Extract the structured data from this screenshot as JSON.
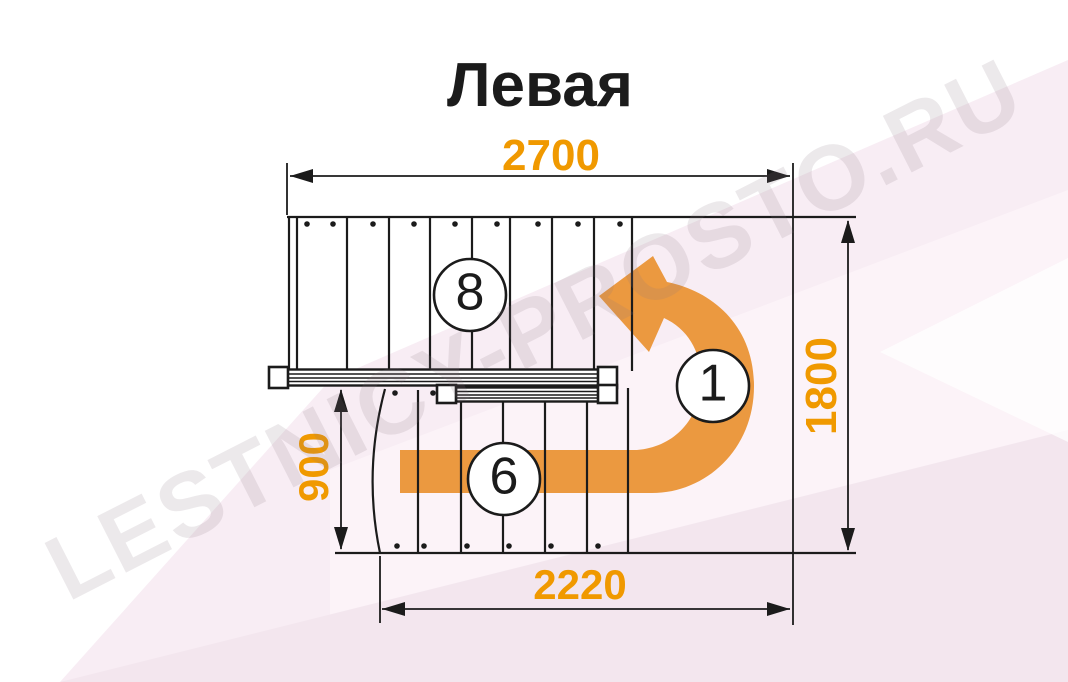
{
  "title": "Левая",
  "watermark": "LESTNICY-PROSTO.RU",
  "dimensions": {
    "top": "2700",
    "right": "1800",
    "left": "900",
    "bottom": "2220"
  },
  "markers": {
    "upper_flight": "8",
    "turn": "1",
    "lower_flight": "6"
  },
  "colors": {
    "dimension_text": "#F09900",
    "arrow_fill": "#EB9940",
    "line": "#1B1B1B",
    "background_tint": "#F8EDF4"
  }
}
